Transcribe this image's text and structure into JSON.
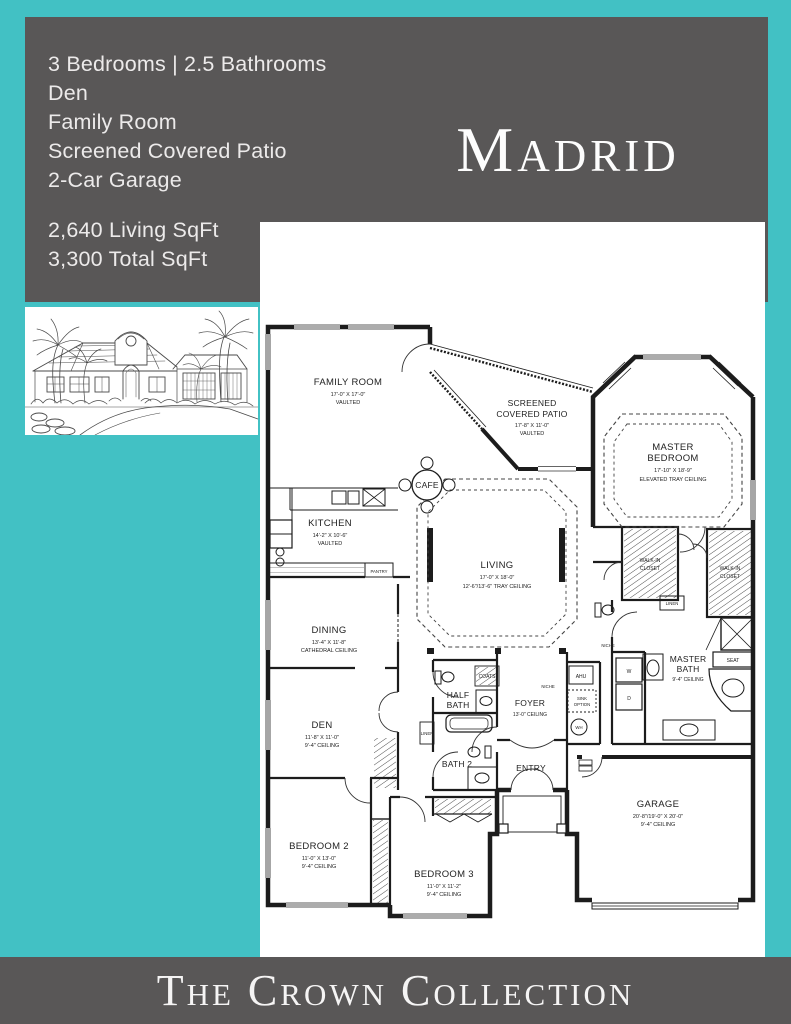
{
  "colors": {
    "teal": "#42c1c4",
    "gray": "#595757",
    "paper": "#ffffff",
    "ink": "#1c1c1c"
  },
  "header": {
    "plan_name": "Madrid",
    "features": [
      "3 Bedrooms | 2.5 Bathrooms",
      "Den",
      "Family Room",
      "Screened Covered Patio",
      "2-Car Garage"
    ],
    "stats": [
      "2,640 Living SqFt",
      "3,300 Total SqFt"
    ]
  },
  "footer": {
    "brand": "The Crown Collection"
  },
  "floorplan": {
    "rooms": {
      "family": {
        "name": "FAMILY ROOM",
        "dims": "17'-0\" X 17'-0\"",
        "ceiling": "VAULTED"
      },
      "patio": {
        "name1": "SCREENED",
        "name2": "COVERED PATIO",
        "dims": "17'-8\" X 11'-0\"",
        "ceiling": "VAULTED"
      },
      "master": {
        "name1": "MASTER",
        "name2": "BEDROOM",
        "dims": "17'-10\" X 18'-9\"",
        "ceiling": "ELEVATED TRAY CEILING"
      },
      "kitchen": {
        "name": "KITCHEN",
        "dims": "14'-2\" X 10'-6\"",
        "ceiling": "VAULTED"
      },
      "cafe": {
        "name": "CAFE"
      },
      "living": {
        "name": "LIVING",
        "dims": "17'-0\" X 18'-0\"",
        "ceiling": "12'-6\"/13'-6\" TRAY CEILING"
      },
      "dining": {
        "name": "DINING",
        "dims": "13'-4\" X 11'-8\"",
        "ceiling": "CATHEDRAL CEILING"
      },
      "den": {
        "name": "DEN",
        "dims": "11'-8\" X 11'-0\"",
        "ceiling": "9'-4\" CEILING"
      },
      "master_bath": {
        "name1": "MASTER",
        "name2": "BATH",
        "ceiling": "9'-4\" CEILING"
      },
      "half_bath": {
        "name1": "HALF",
        "name2": "BATH"
      },
      "bath2": {
        "name": "BATH 2"
      },
      "foyer": {
        "name": "FOYER",
        "ceiling": "13'-0\" CEILING"
      },
      "entry": {
        "name": "ENTRY"
      },
      "bedroom2": {
        "name": "BEDROOM 2",
        "dims": "11'-0\" X 13'-0\"",
        "ceiling": "9'-4\" CEILING"
      },
      "bedroom3": {
        "name": "BEDROOM 3",
        "dims": "11'-0\" X 11'-2\"",
        "ceiling": "9'-4\" CEILING"
      },
      "garage": {
        "name": "GARAGE",
        "dims": "20'-8\"/19'-0\" X 20'-0\"",
        "ceiling": "9'-4\" CEILING"
      },
      "wic1": {
        "name1": "WALK-IN",
        "name2": "CLOSET"
      },
      "wic2": {
        "name1": "WALK-IN",
        "name2": "CLOSET"
      }
    },
    "labels": {
      "pantry": "PANTRY",
      "linen1": "LINEN",
      "linen2": "LINEN",
      "niche1": "NICHE",
      "niche2": "NICHE",
      "coats": "COATS",
      "seat": "SEAT",
      "ahu": "AHU",
      "washer": "W",
      "dryer": "D",
      "water_heater": "WH",
      "sink_line1": "SINK",
      "sink_line2": "OPTION"
    }
  }
}
